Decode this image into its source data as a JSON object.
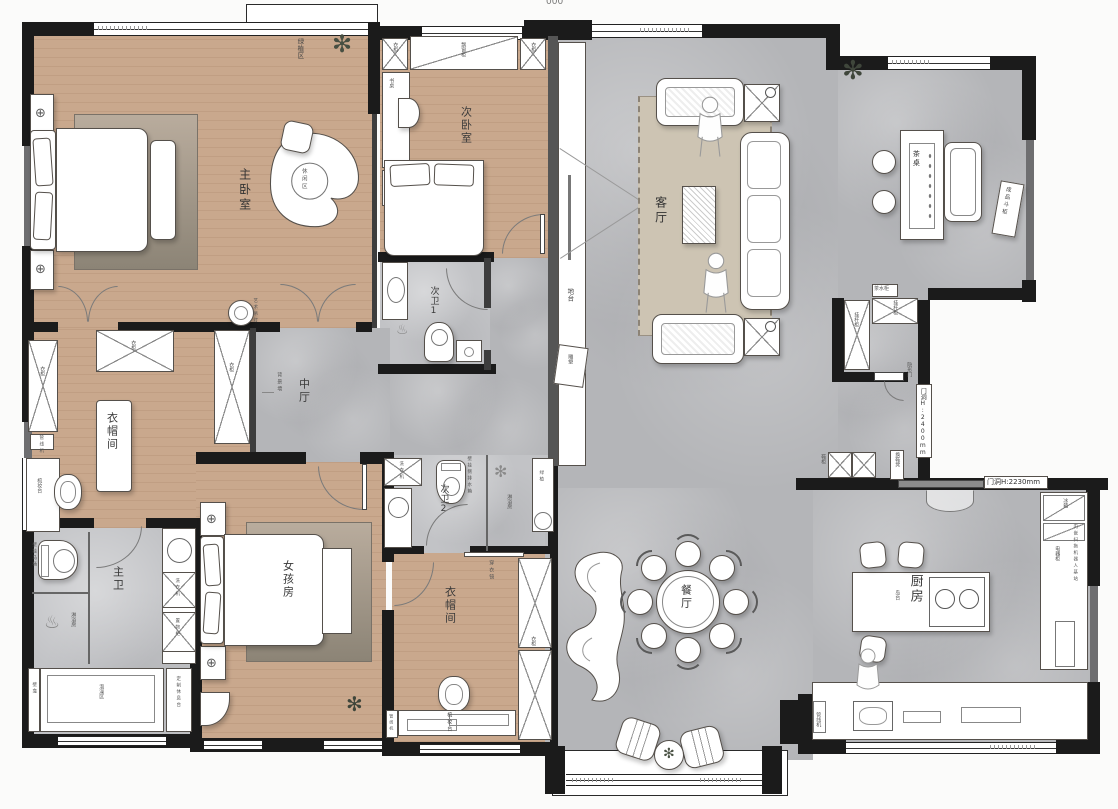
{
  "meta": {
    "top_mark": "000"
  },
  "rooms": {
    "master_bedroom": "主卧室",
    "second_bedroom": "次卧室",
    "bath1": "次卫1",
    "bath2": "次卫2",
    "master_bath": "主卫",
    "girls_room": "女孩房",
    "closet1": "衣帽间",
    "closet2": "衣帽间",
    "mid_hall": "中厅",
    "living_room": "客厅",
    "dining_room": "餐厅",
    "kitchen": "厨房"
  },
  "labels": {
    "wardrobe": "衣柜",
    "bay_window_cabinet": "飘窗柜",
    "desk": "书桌",
    "leisure_area": "休闲区",
    "green_plant_area": "绿植区",
    "platform": "地台",
    "sculpture": "雕塑",
    "tea_table": "茶桌",
    "finished_chest": "成品斗柜",
    "hanging_rod_cabinet": "挂杆柜",
    "tea_cabinet": "茶水柜",
    "hidden_door": "隐形门",
    "door_height_2400": "门洞H:2400mm",
    "door_height_2230": "门洞H:2230mm",
    "shoe_cabinet": "鞋柜",
    "shoe_bench": "换鞋凳",
    "island_counter": "岛台",
    "fridge": "冰箱",
    "appliance_cabinet": "电器柜",
    "robot_dock": "内嵌扫拖机器人基站",
    "water_dispenser": "管线机",
    "washer": "洗衣机",
    "shower_room": "淋浴房",
    "wall_hung_cistern": "壁挂侧排水箱",
    "wall_hung_toilet": "壁挂马桶",
    "green_plant": "绿植",
    "dressing_mirror": "穿衣镜",
    "dressing_table": "梳妆台",
    "storage_cabinet": "置物柜",
    "soaking_area": "泡澡区",
    "custom_rest_counter": "定制休息台",
    "niche": "壁龛",
    "feature_wall": "背景墙",
    "art_pendant": "艺术吊灯"
  }
}
